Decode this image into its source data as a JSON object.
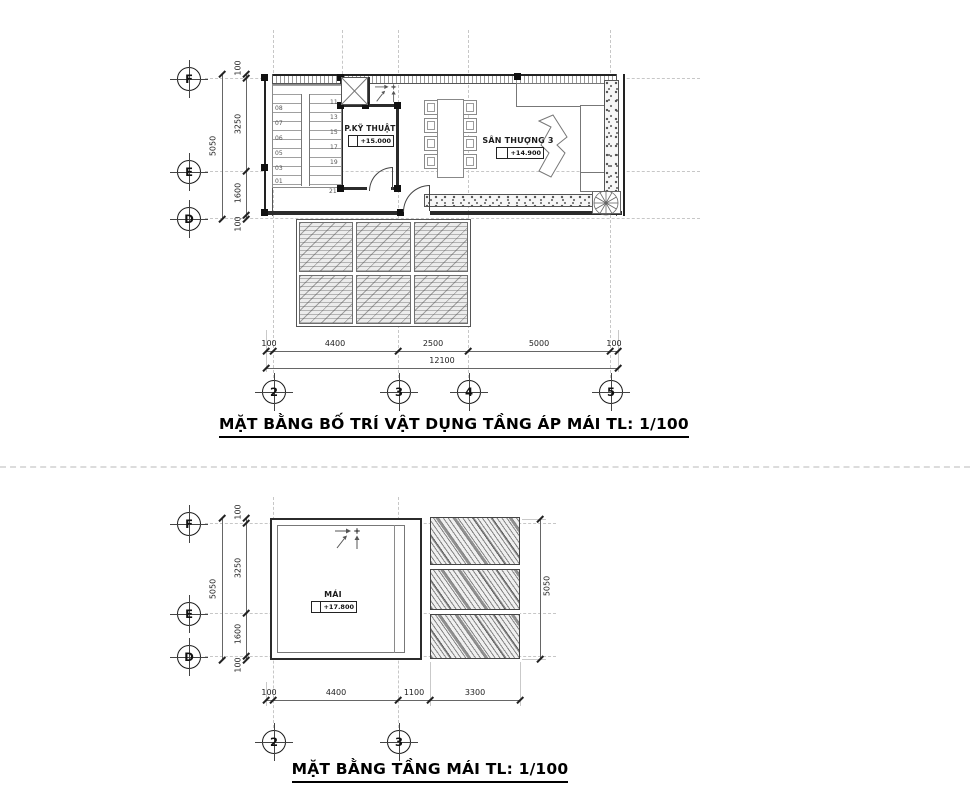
{
  "meta": {
    "bg": "#ffffff",
    "ink": "#2b2b2b",
    "grid_color": "#c7c7c7"
  },
  "icons": {
    "skylight": "crossed-skylight-icon",
    "plant": "plant-icon",
    "slope": "slope-arrow-icon",
    "door": "door-swing-icon"
  },
  "plan1": {
    "title": "MẶT BẰNG BỐ TRÍ VẬT DỤNG TẦNG ÁP MÁI TL: 1/100",
    "grid_rows": [
      "F",
      "E",
      "D"
    ],
    "grid_cols": [
      "2",
      "3",
      "4",
      "5"
    ],
    "dims_left": [
      "100",
      "3250",
      "1600",
      "100"
    ],
    "dims_left_total": "5050",
    "dims_bottom": [
      "100",
      "4400",
      "2500",
      "5000",
      "100"
    ],
    "dims_bottom_total": "12100",
    "rooms": {
      "technical": {
        "name": "P.KỸ THUẬT",
        "level": "+15.000"
      },
      "terrace": {
        "name": "SÂN THƯỢNG 3",
        "level": "+14.900"
      }
    },
    "stair": {
      "left_numbers": [
        "08",
        "07",
        "06",
        "05",
        "03",
        "01"
      ],
      "right_numbers": [
        "11",
        "13",
        "15",
        "17",
        "19"
      ],
      "bottom_number": "21"
    }
  },
  "plan2": {
    "title": "MẶT BẰNG TẦNG MÁI TL: 1/100",
    "grid_rows": [
      "F",
      "E",
      "D"
    ],
    "grid_cols": [
      "2",
      "3"
    ],
    "dims_left": [
      "100",
      "3250",
      "1600",
      "100"
    ],
    "dims_left_total": "5050",
    "dims_right_total": "5050",
    "dims_bottom": [
      "100",
      "4400",
      "1100",
      "3300"
    ],
    "room": {
      "name": "MÁI",
      "level": "+17.800"
    }
  }
}
